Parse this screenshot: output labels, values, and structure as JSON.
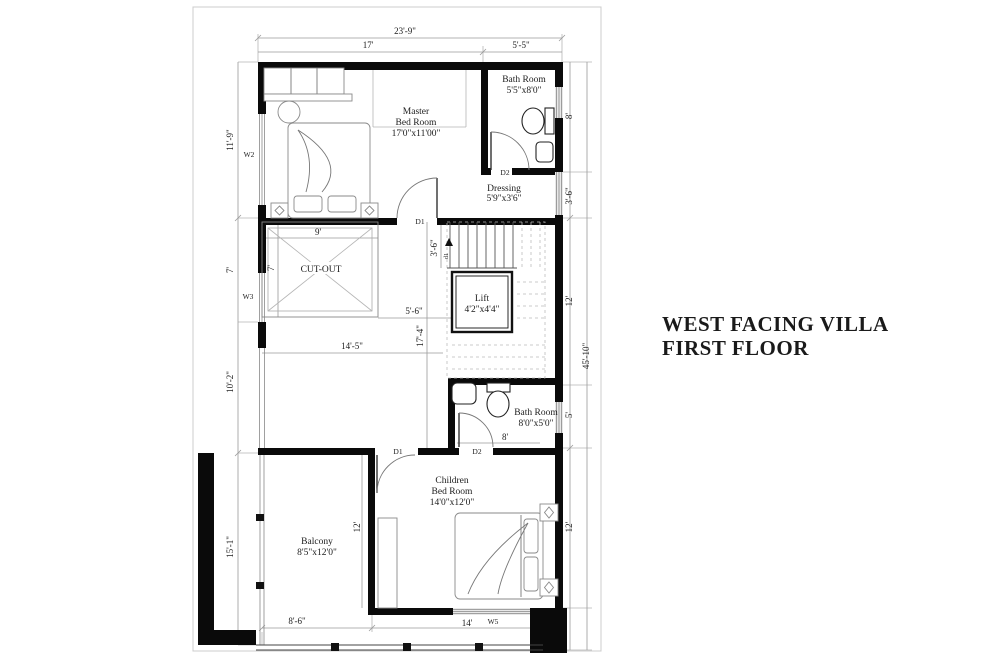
{
  "title": {
    "line1": "WEST FACING VILLA",
    "line2": "FIRST FLOOR"
  },
  "rooms": {
    "master_bedroom": {
      "name_line1": "Master",
      "name_line2": "Bed Room",
      "size": "17'0\"x11'00\""
    },
    "bath_top": {
      "name_line1": "Bath Room",
      "size": "5'5\"x8'0\""
    },
    "dressing": {
      "name_line1": "Dressing",
      "size": "5'9\"x3'6\""
    },
    "cut_out": {
      "name_line1": "CUT-OUT"
    },
    "lift": {
      "name_line1": "Lift",
      "size": "4'2\"x4'4\""
    },
    "bath_mid": {
      "name_line1": "Bath Room",
      "size": "8'0\"x5'0\""
    },
    "children_bedroom": {
      "name_line1": "Children",
      "name_line2": "Bed Room",
      "size": "14'0\"x12'0\""
    },
    "balcony": {
      "name_line1": "Balcony",
      "size": "8'5\"x12'0\""
    }
  },
  "dimensions": {
    "overall_width": "23'-9\"",
    "top_left_width": "17'",
    "top_right_width": "5'-5\"",
    "left_upper": "11'-9\"",
    "left_mid": "7'",
    "cutout_width": "9'",
    "cutout_height": "7'",
    "left_lower": "10'-2\"",
    "left_bottom": "15'-1\"",
    "hall_gap": "5'-6\"",
    "hall_height": "17'-4\"",
    "hall_width": "14'-5\"",
    "stair_width": "3'-6\"",
    "right_bath_top": "8'",
    "right_dressing": "3'-6\"",
    "right_stairs": "12'",
    "right_bath_mid": "5'",
    "right_children": "12'",
    "overall_height": "45'-10\"",
    "bottom_balcony": "8'-6\"",
    "bottom_children": "14'",
    "bath_mid_width": "8'",
    "divider_height": "12'"
  },
  "tags": {
    "w2": "W2",
    "w3": "W3",
    "w5": "W5",
    "d1_master": "D1",
    "d2_bath_top": "D2",
    "d1_children": "D1",
    "d2_bath_mid": "D2",
    "stair_door": "d1"
  },
  "colors": {
    "wall": "#0a0a0a",
    "thin_line": "#777777",
    "dimension_line": "#9a9a9a",
    "text": "#1c1c1c",
    "background": "#ffffff"
  }
}
